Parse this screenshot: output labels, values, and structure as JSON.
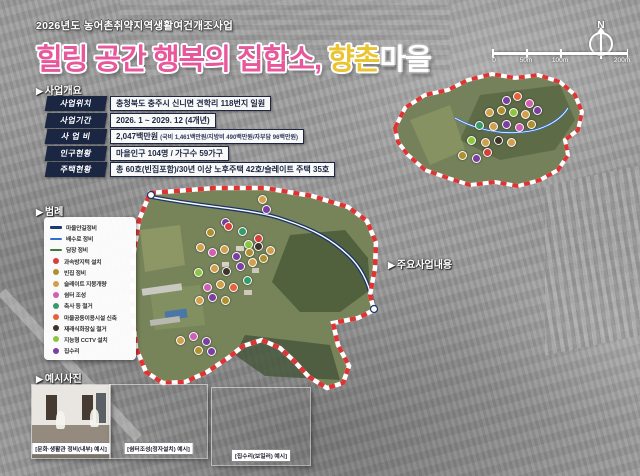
{
  "header": {
    "subtitle": "2026년도 농어촌취약지역생활여건개조사업",
    "title_pink": "힐링 공간 행복의 집합소,",
    "title_yellow": "향촌",
    "title_white": "마을",
    "title_pink_color": "#e8579b",
    "title_yellow_color": "#eac431"
  },
  "compass": {
    "label": "N"
  },
  "scalebar": {
    "labels": [
      "0",
      "50m",
      "100m",
      "200m"
    ]
  },
  "overview": {
    "header": "사업개요",
    "rows": [
      {
        "label": "사업위치",
        "value": "충청북도 충주시 신니면 견학리 118번지 일원"
      },
      {
        "label": "사업기간",
        "value": "2026. 1 ~ 2029. 12 (4개년)"
      },
      {
        "label": "사 업 비",
        "value": "2,047백만원",
        "note": "(국비 1,461백만원/지방비 490백만원/자부담 96백만원)"
      },
      {
        "label": "인구현황",
        "value": "마을인구 104명 / 가구수 59가구"
      },
      {
        "label": "주택현황",
        "value": "총 60호(빈집포함)/30년 이상 노후주택 42호/슬레이트 주택 35호"
      }
    ]
  },
  "legend": {
    "header": "범례",
    "items": [
      {
        "id": "road",
        "label": "마을안길정비",
        "shape": "line",
        "color": "#1e3a6e"
      },
      {
        "id": "drain",
        "label": "배수로 정비",
        "shape": "line",
        "color": "#2f6fd0"
      },
      {
        "id": "fence",
        "label": "담장 정비",
        "shape": "line",
        "color": "#3c7d3c"
      },
      {
        "id": "speedbump",
        "label": "과속방지턱 설치",
        "shape": "dot",
        "color": "#d6403c"
      },
      {
        "id": "emptyhouse",
        "label": "빈집 정비",
        "shape": "dot",
        "color": "#b08f2e"
      },
      {
        "id": "slate",
        "label": "슬레이트 지붕개량",
        "shape": "dot",
        "color": "#d2a04c"
      },
      {
        "id": "shelter",
        "label": "쉼터 조성",
        "shape": "dot",
        "color": "#d05fb4"
      },
      {
        "id": "barn",
        "label": "축사 등 철거",
        "shape": "dot",
        "color": "#369a6a"
      },
      {
        "id": "facility",
        "label": "마을공동이용시설 신축",
        "shape": "dot",
        "color": "#e2633c"
      },
      {
        "id": "toilet",
        "label": "재래식화장실 철거",
        "shape": "dot",
        "color": "#3d332a"
      },
      {
        "id": "cctv",
        "label": "지능형 CCTV 설치",
        "shape": "dot",
        "color": "#8cc63f"
      },
      {
        "id": "repair",
        "label": "집수리",
        "shape": "dot",
        "color": "#7b3fa0"
      }
    ]
  },
  "photos": {
    "header": "예시사진",
    "items": [
      {
        "caption": "[문화·생활관 정비(내부) 예시]"
      },
      {
        "caption": "[쉼터조성(정자설치) 예시]"
      },
      {
        "caption": "[집수리(보일러) 예시]"
      }
    ]
  },
  "projects": {
    "header": "주요사업내용",
    "tables": [
      {
        "title": "주택정비",
        "total": "710,000천원",
        "header_color": "#c49a1f",
        "tag_color": "#c49a1f",
        "rows": [
          {
            "tag": "가-1",
            "label": "빈집 정비",
            "note": "(철거지원사업)",
            "value": "30,000천원"
          },
          {
            "tag": "가-2",
            "label": "슬레이트 지붕 개량",
            "value": "374,000천원"
          },
          {
            "tag": "가-3",
            "label": "집수리",
            "value": "306,000천원"
          }
        ]
      },
      {
        "title": "생활·위생·안전인프라",
        "total": "951,570천원",
        "header_color": "#2b5fa8",
        "tag_color": "#2b5fa8",
        "rows": [
          {
            "tag": "나-1",
            "label": "재래식화장실 철거",
            "value": "20,000천원"
          },
          {
            "tag": "나-2",
            "label": "마을안길 정비",
            "value": "66,000천원"
          },
          {
            "tag": "나-3",
            "label": "배수로 정비",
            "value": "132,000천원"
          },
          {
            "tag": "나-4",
            "label": "과속방지턱 설치",
            "value": "10,000천원"
          },
          {
            "tag": "나-5",
            "label": "마을 공동이용시설 신축",
            "value": "673,570천원"
          },
          {
            "tag": "나-6",
            "label": "지능형 CCTV 설치",
            "value": "50,000천원"
          }
        ]
      },
      {
        "title": "마을환경개선 계획",
        "total": "230,500천원",
        "header_color": "#3f9e38",
        "tag_color": "#3f9e38",
        "rows": [
          {
            "tag": "다-1",
            "label": "혐오시설 철거",
            "value": "96,000천원"
          },
          {
            "tag": "다-2",
            "label": "담장 정비",
            "value": "84,500천원"
          },
          {
            "tag": "다-3",
            "label": "쉼터조성",
            "value": "50,000천원"
          }
        ]
      },
      {
        "title": "휴먼케어 및 주민역량강화",
        "total": "55,000천원",
        "header_color": "#e8872a",
        "tag_color": "#dd5746",
        "rows": [
          {
            "tag": "라-1",
            "label": "집수리 교육",
            "value": "10,000천원"
          },
          {
            "tag": "라-2",
            "label": "지역 특화식품 교육",
            "value": "10,000천원"
          },
          {
            "tag": "라-3",
            "label": "스마트 정보화교육",
            "value": "10,000천원"
          },
          {
            "tag": "라-4",
            "label": "국내 선진지 견학",
            "value": "5,000천원"
          },
          {
            "tag": "라-5",
            "label": "리더 교육",
            "value": "10,000천원"
          },
          {
            "tag": "라-6",
            "label": "주민 교육",
            "value": "10,000천원"
          }
        ]
      }
    ]
  },
  "map": {
    "markers": [
      {
        "x": 225,
        "y": 222,
        "type": "repair"
      },
      {
        "x": 210,
        "y": 232,
        "type": "emptyhouse"
      },
      {
        "x": 262,
        "y": 199,
        "type": "slate"
      },
      {
        "x": 266,
        "y": 209,
        "type": "repair"
      },
      {
        "x": 228,
        "y": 226,
        "type": "speedbump"
      },
      {
        "x": 242,
        "y": 231,
        "type": "barn"
      },
      {
        "x": 258,
        "y": 238,
        "type": "speedbump"
      },
      {
        "x": 248,
        "y": 244,
        "type": "cctv"
      },
      {
        "x": 200,
        "y": 247,
        "type": "slate"
      },
      {
        "x": 212,
        "y": 252,
        "type": "shelter"
      },
      {
        "x": 224,
        "y": 249,
        "type": "slate"
      },
      {
        "x": 236,
        "y": 256,
        "type": "repair"
      },
      {
        "x": 249,
        "y": 252,
        "type": "emptyhouse"
      },
      {
        "x": 198,
        "y": 272,
        "type": "cctv"
      },
      {
        "x": 214,
        "y": 268,
        "type": "slate"
      },
      {
        "x": 226,
        "y": 271,
        "type": "toilet"
      },
      {
        "x": 240,
        "y": 266,
        "type": "repair"
      },
      {
        "x": 252,
        "y": 262,
        "type": "slate"
      },
      {
        "x": 263,
        "y": 258,
        "type": "emptyhouse"
      },
      {
        "x": 207,
        "y": 287,
        "type": "shelter"
      },
      {
        "x": 220,
        "y": 284,
        "type": "slate"
      },
      {
        "x": 233,
        "y": 287,
        "type": "facility"
      },
      {
        "x": 247,
        "y": 280,
        "type": "barn"
      },
      {
        "x": 199,
        "y": 300,
        "type": "slate"
      },
      {
        "x": 212,
        "y": 297,
        "type": "repair"
      },
      {
        "x": 225,
        "y": 300,
        "type": "emptyhouse"
      },
      {
        "x": 258,
        "y": 246,
        "type": "toilet"
      },
      {
        "x": 270,
        "y": 250,
        "type": "slate"
      },
      {
        "x": 180,
        "y": 340,
        "type": "slate"
      },
      {
        "x": 193,
        "y": 336,
        "type": "shelter"
      },
      {
        "x": 206,
        "y": 341,
        "type": "repair"
      },
      {
        "x": 198,
        "y": 350,
        "type": "emptyhouse"
      },
      {
        "x": 211,
        "y": 351,
        "type": "repair"
      },
      {
        "x": 506,
        "y": 100,
        "type": "repair"
      },
      {
        "x": 517,
        "y": 96,
        "type": "facility"
      },
      {
        "x": 529,
        "y": 103,
        "type": "shelter"
      },
      {
        "x": 489,
        "y": 112,
        "type": "slate"
      },
      {
        "x": 501,
        "y": 110,
        "type": "emptyhouse"
      },
      {
        "x": 513,
        "y": 112,
        "type": "cctv"
      },
      {
        "x": 525,
        "y": 114,
        "type": "slate"
      },
      {
        "x": 537,
        "y": 110,
        "type": "repair"
      },
      {
        "x": 479,
        "y": 125,
        "type": "barn"
      },
      {
        "x": 493,
        "y": 126,
        "type": "slate"
      },
      {
        "x": 506,
        "y": 124,
        "type": "repair"
      },
      {
        "x": 519,
        "y": 127,
        "type": "shelter"
      },
      {
        "x": 531,
        "y": 124,
        "type": "emptyhouse"
      },
      {
        "x": 471,
        "y": 140,
        "type": "cctv"
      },
      {
        "x": 485,
        "y": 142,
        "type": "slate"
      },
      {
        "x": 498,
        "y": 140,
        "type": "toilet"
      },
      {
        "x": 511,
        "y": 142,
        "type": "slate"
      },
      {
        "x": 487,
        "y": 152,
        "type": "speedbump"
      },
      {
        "x": 462,
        "y": 155,
        "type": "emptyhouse"
      },
      {
        "x": 476,
        "y": 158,
        "type": "repair"
      }
    ]
  }
}
